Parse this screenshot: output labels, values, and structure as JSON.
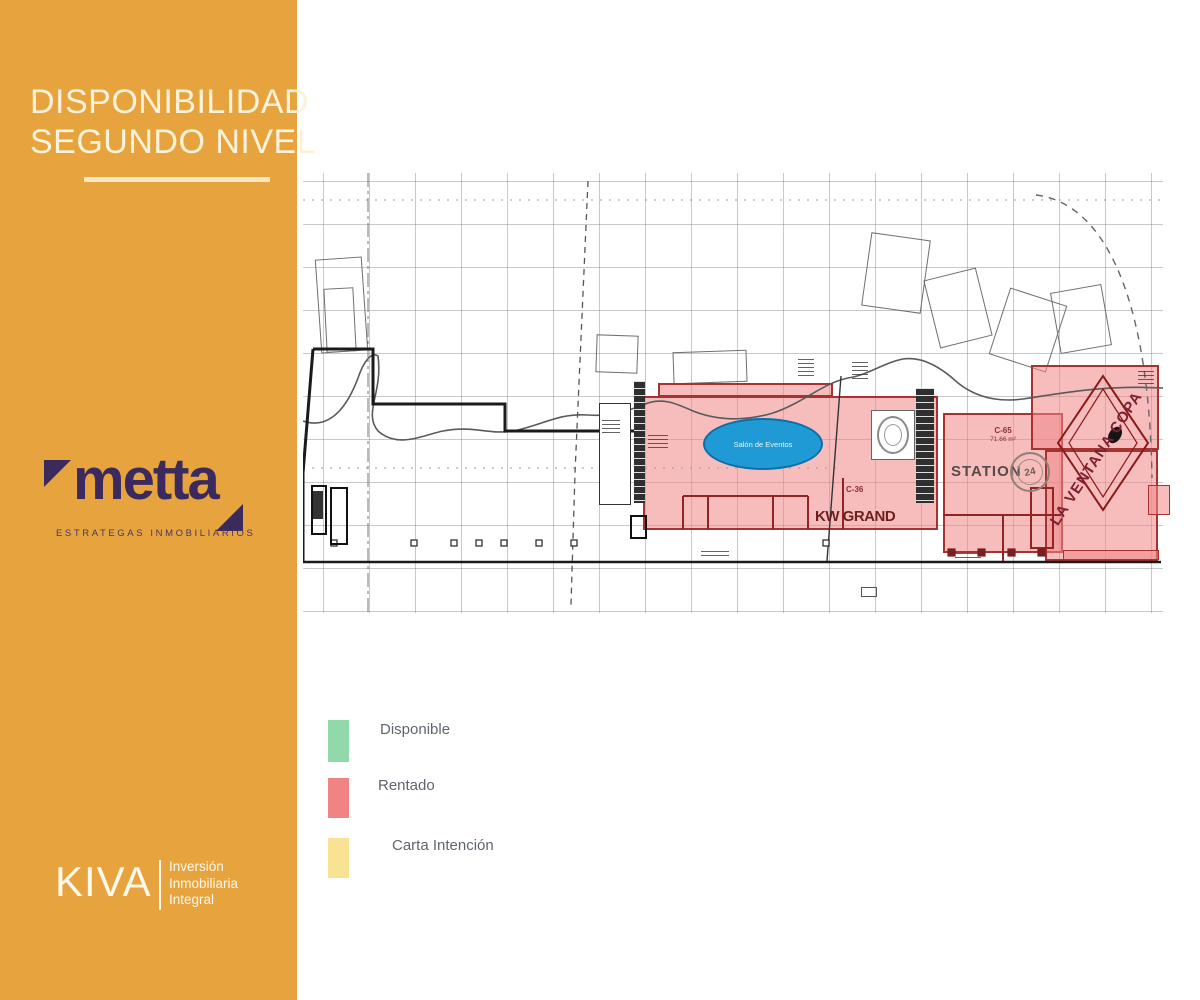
{
  "colors": {
    "panel_orange": "#E7A43E",
    "metta_purple": "#3B2A5D",
    "available_green": "#92D9A9",
    "rented_red": "#F18383",
    "intent_yellow": "#F9E291",
    "event_hall_blue": "#1F9AD4"
  },
  "brand": {
    "title_line1": "DISPONIBILIDAD",
    "title_line2": "SEGUNDO NIVEL",
    "metta_name": "metta",
    "metta_tagline": "ESTRATEGAS INMOBILIARIOS",
    "kiva_name": "KIVA",
    "kiva_tagline_line1": "Inversión",
    "kiva_tagline_line2": "Inmobiliaria",
    "kiva_tagline_line3": "Integral"
  },
  "legend": {
    "items": [
      {
        "label": "Disponible",
        "color": "#92D9A9"
      },
      {
        "label": "Rentado",
        "color": "#F18383"
      },
      {
        "label": "Carta Intención",
        "color": "#F9E291"
      }
    ]
  },
  "floorplan": {
    "event_hall": {
      "label": "Salón de Eventos"
    },
    "units": [
      {
        "id": "C-36",
        "tenant": "KW GRAND",
        "status": "Rentado"
      },
      {
        "id": "C-65",
        "area": "71.66 m²",
        "tenant": "STATION",
        "badge": "24",
        "status": "Rentado"
      },
      {
        "tenant": "LA VENTANA COPA",
        "status": "Rentado"
      }
    ]
  }
}
